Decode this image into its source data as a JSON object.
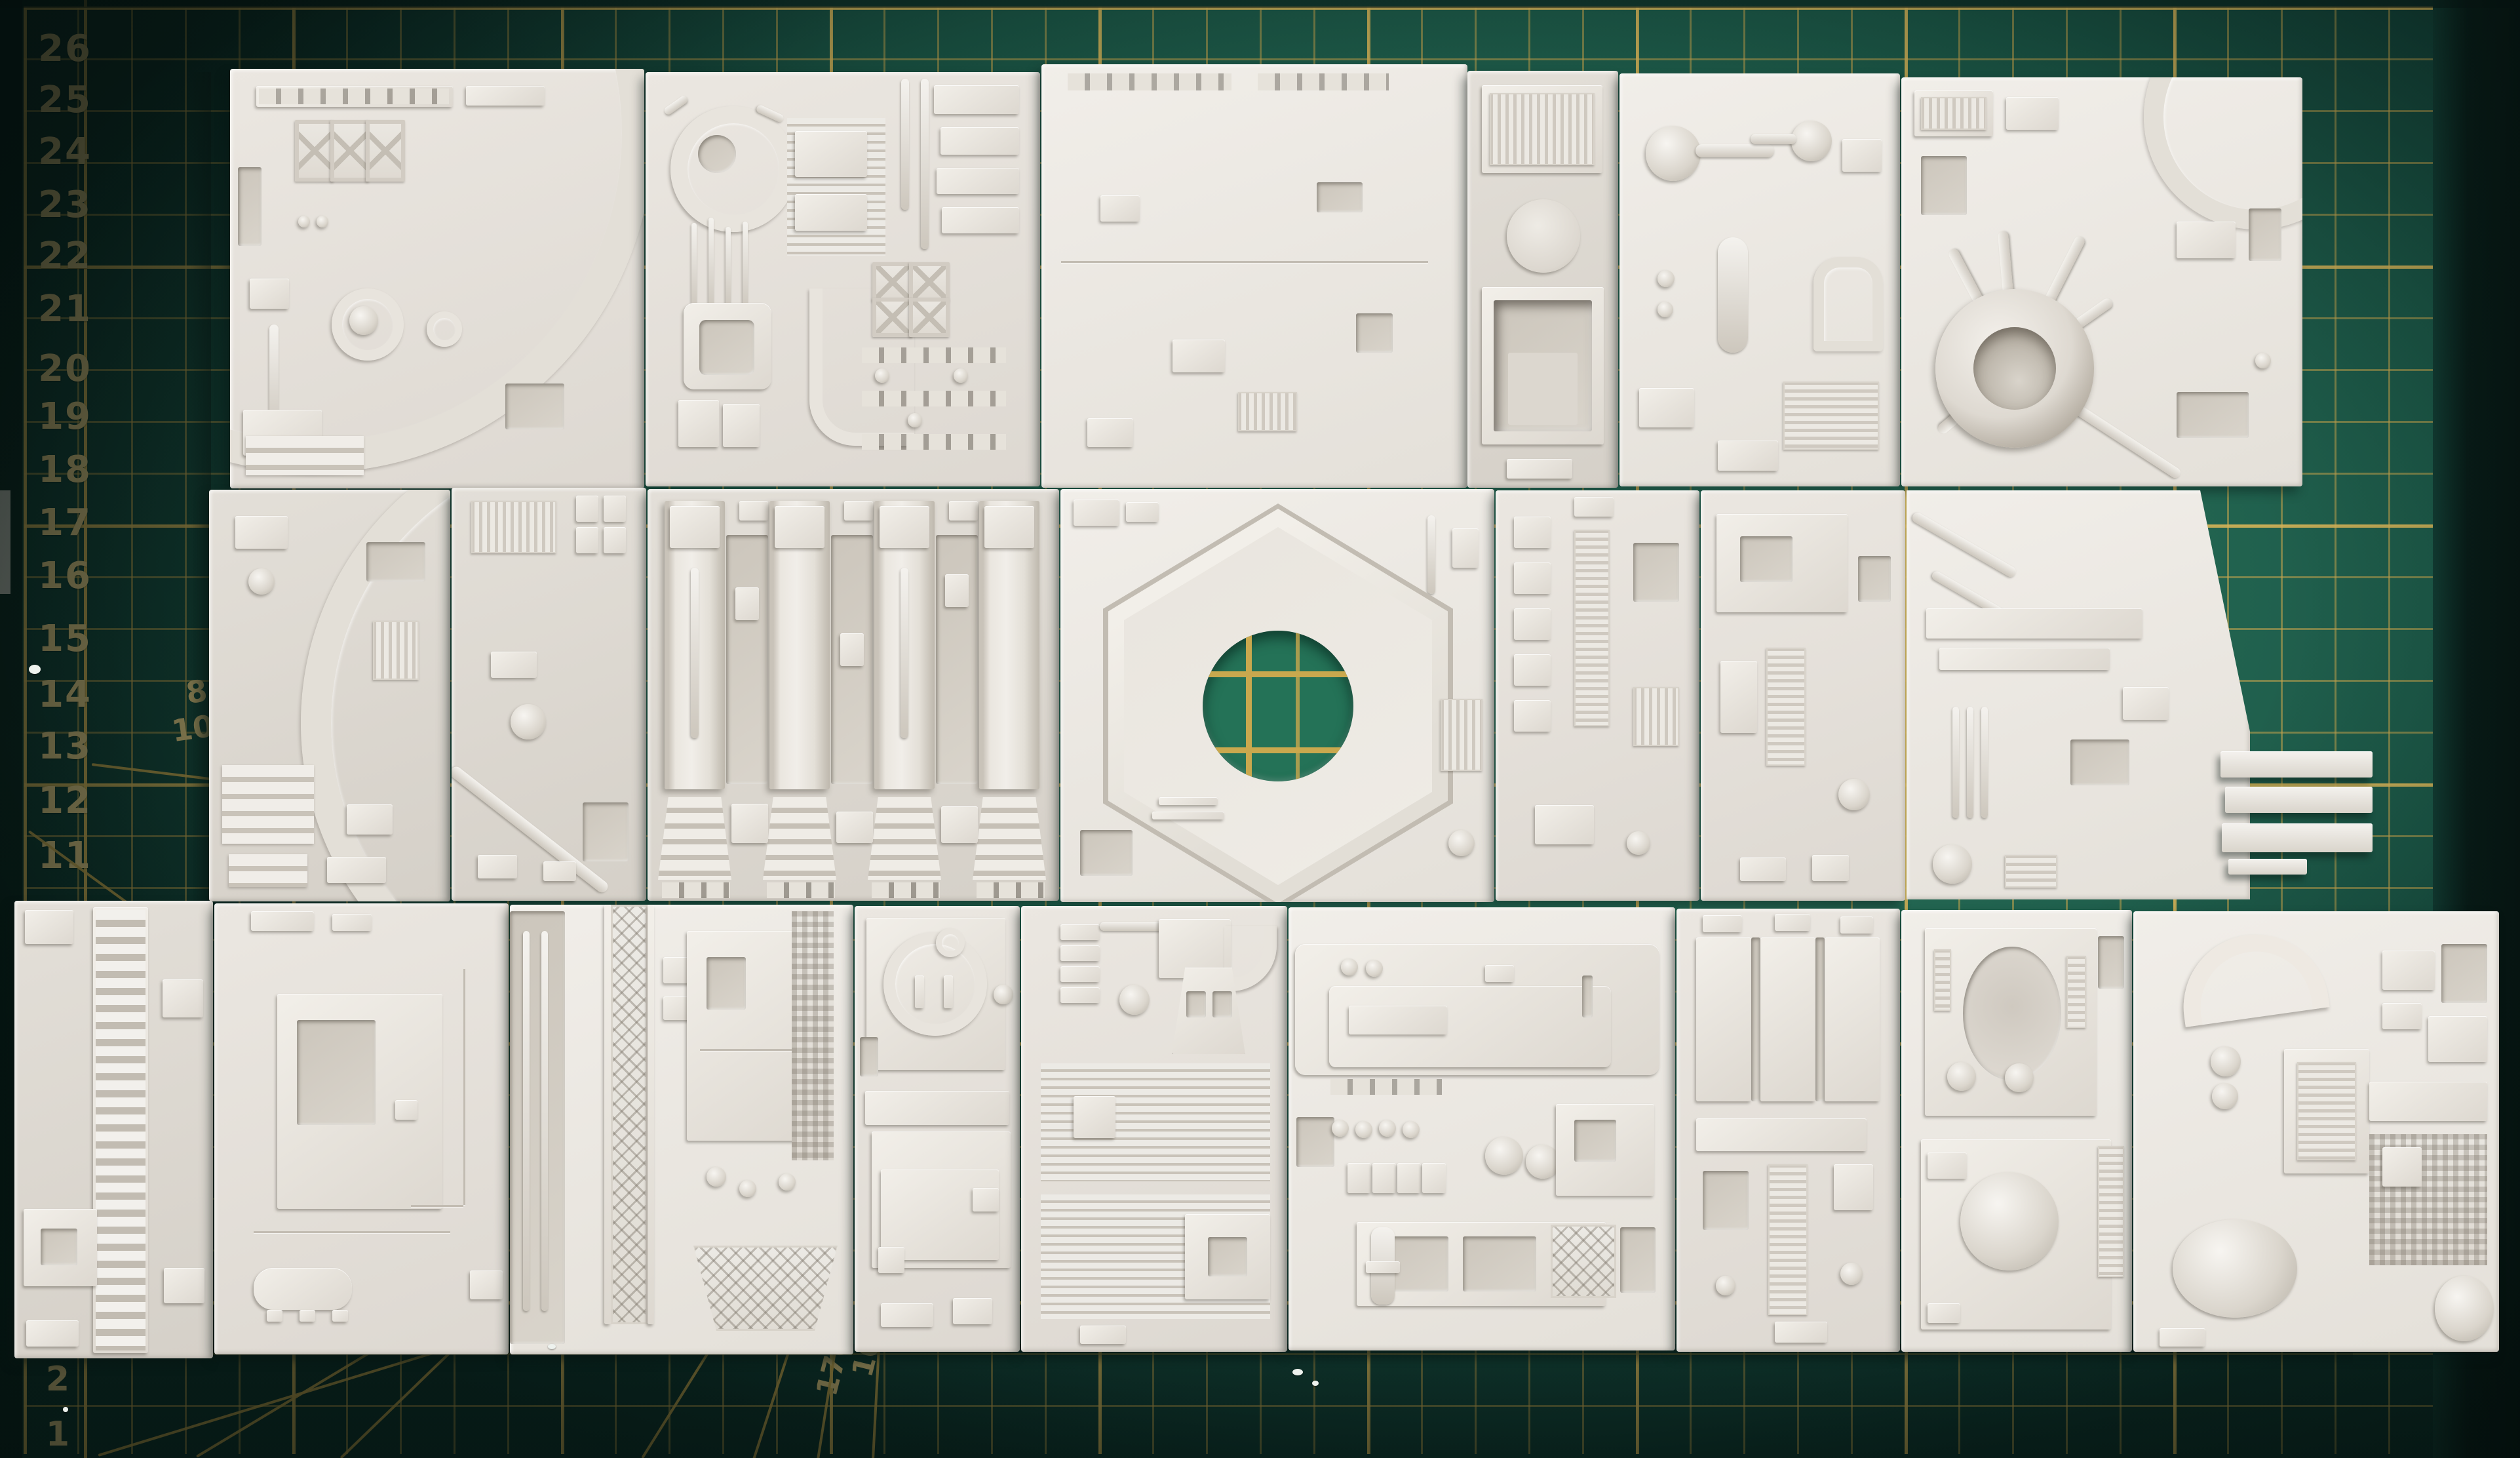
{
  "scene": {
    "description": "Twenty-two white 3D-printed Death Star style greeble tiles arranged in three rows on a green self-healing cutting mat with yellow grid",
    "tile_count": "22"
  },
  "mat": {
    "surface_color": "#1f6150",
    "grid_color": "#c7a54d",
    "numeral_color": "#dcc482",
    "hole_surface_color": "#247257",
    "ruler_left": [
      "26",
      "25",
      "24",
      "23",
      "22",
      "21",
      "20",
      "19",
      "18",
      "17",
      "16",
      "15",
      "14",
      "13",
      "12",
      "11"
    ],
    "ruler_bottom": [
      "2",
      "1"
    ],
    "angle_left": [
      "8",
      "10"
    ],
    "angle_bottom": [
      "10",
      "170"
    ]
  },
  "panels": {
    "material_color": "#e9e5de"
  }
}
